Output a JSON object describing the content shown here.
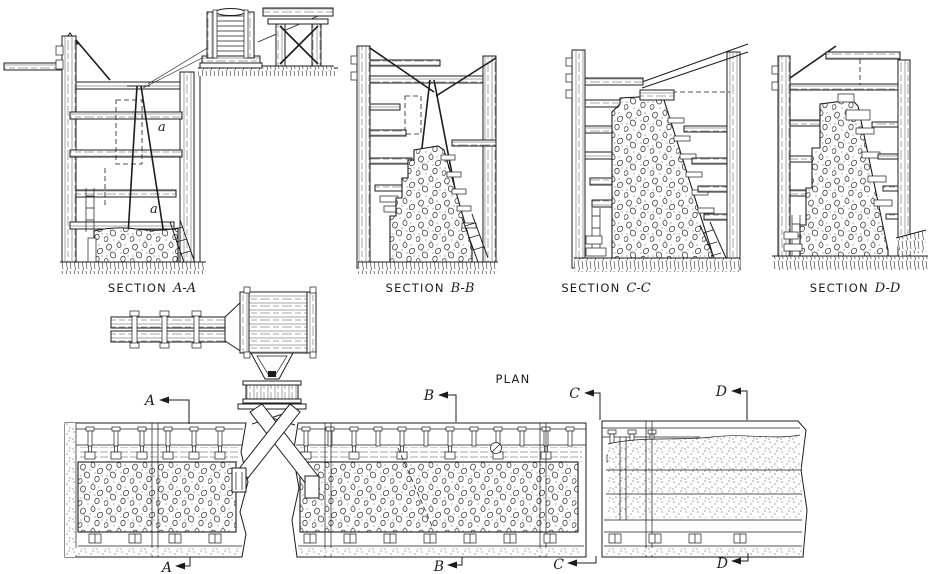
{
  "figure": {
    "paper_color": "#ffffff",
    "ink_color": "#1c1c1c",
    "description": "Progressive stages of concrete wall construction in trench forms, four cross sections and a plan"
  },
  "sections": [
    {
      "prefix": "SECTION",
      "name": "A-A"
    },
    {
      "prefix": "SECTION",
      "name": "B-B"
    },
    {
      "prefix": "SECTION",
      "name": "C-C"
    },
    {
      "prefix": "SECTION",
      "name": "D-D"
    }
  ],
  "annotations": {
    "brace_upper": "a",
    "brace_lower": "a"
  },
  "plan": {
    "title": "PLAN",
    "cut_markers_top": [
      {
        "letter": "A"
      },
      {
        "letter": "B"
      },
      {
        "letter": "C"
      },
      {
        "letter": "D"
      }
    ],
    "cut_markers_bottom": [
      {
        "letter": "A"
      },
      {
        "letter": "B"
      },
      {
        "letter": "C"
      },
      {
        "letter": "D"
      }
    ]
  }
}
